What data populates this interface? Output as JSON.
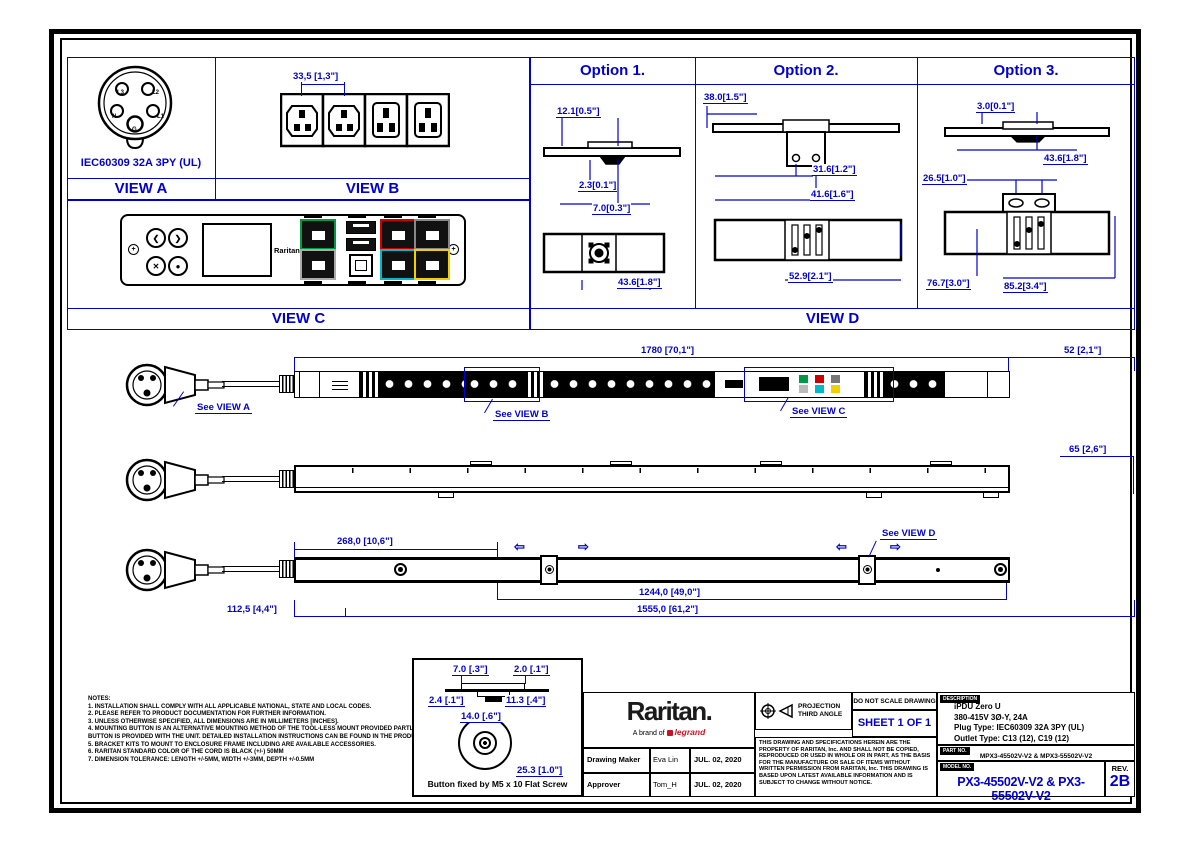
{
  "views": {
    "a": {
      "label": "VIEW A",
      "caption": "IEC60309 32A 3PY (UL)",
      "pins": [
        "L3",
        "L2",
        "N",
        "L1",
        "G"
      ]
    },
    "b": {
      "label": "VIEW B",
      "dim": "33,5 [1,3\"]"
    },
    "c": {
      "label": "VIEW C",
      "brand": "Raritan"
    },
    "d": {
      "label": "VIEW D"
    }
  },
  "options": [
    {
      "title": "Option 1.",
      "d1": "12.1[0.5\"]",
      "d2": "2.3[0.1\"]",
      "d3": "7.0[0.3\"]",
      "d4": "43.6[1.8\"]"
    },
    {
      "title": "Option 2.",
      "d1": "38.0[1.5\"]",
      "d2": "31.6[1.2\"]",
      "d3": "41.6[1.6\"]",
      "d4": "52.9[2.1\"]"
    },
    {
      "title": "Option 3.",
      "d1": "3.0[0.1\"]",
      "d2": "43.6[1.8\"]",
      "d3": "26.5[1.0\"]",
      "d4": "76.7[3.0\"]",
      "d5": "85.2[3.4\"]"
    }
  ],
  "assembly": {
    "front": {
      "dim_total": "1780 [70,1\"]",
      "dim_end": "52 [2,1\"]",
      "see_a": "See VIEW A",
      "see_b": "See VIEW B",
      "see_c": "See VIEW C"
    },
    "side": {
      "dim_depth": "65 [2,6\"]"
    },
    "rear": {
      "dim_offset": "268,0 [10,6\"]",
      "dim_span": "1244,0 [49,0\"]",
      "dim_overall": "1555,0 [61,2\"]",
      "dim_start": "112,5 [4,4\"]",
      "see_d": "See VIEW D"
    }
  },
  "button_detail": {
    "d1": "7.0 [.3\"]",
    "d2": "2.0 [.1\"]",
    "d3": "2.4 [.1\"]",
    "d4": "11.3 [.4\"]",
    "d5": "14.0 [.6\"]",
    "d6": "25.3 [1.0\"]",
    "caption": "Button fixed by M5 x 10 Flat Screw"
  },
  "notes": {
    "title": "NOTES:",
    "lines": [
      "1. INSTALLATION SHALL COMPLY WITH ALL APPLICABLE NATIONAL, STATE AND LOCAL CODES.",
      "2. PLEASE REFER TO PRODUCT DOCUMENTATION FOR FURTHER INFORMATION.",
      "3. UNLESS OTHERWISE SPECIFIED, ALL DIMENSIONS ARE IN MILLIMETERS [INCHES].",
      "4. MOUNTING BUTTON IS AN ALTERNATIVE MOUNTING METHOD OF THE TOOL-LESS MOUNT PROVIDED PARTLY ENCLOSURE.",
      "    BUTTON IS PROVIDED WITH THE UNIT. DETAILED INSTALLATION INSTRUCTIONS CAN BE FOUND IN THE PRODUCT MANUAL.",
      "5. BRACKET KITS TO MOUNT TO ENCLOSURE FRAME INCLUDING ARE AVAILABLE ACCESSORIES.",
      "6. RARITAN STANDARD COLOR OF THE CORD IS BLACK (+/-) 50MM",
      "7. DIMENSION TOLERANCE: LENGTH +/-5MM, WIDTH +/-3MM, DEPTH +/-0.5MM"
    ]
  },
  "title_block": {
    "brand": "Raritan.",
    "brand_sub_prefix": "A brand of",
    "brand_sub_highlight": "legrand",
    "rows": [
      {
        "label": "Drawing Maker",
        "name": "Eva Lin",
        "date": "JUL. 02, 2020"
      },
      {
        "label": "Approver",
        "name": "Tom_H",
        "date": "JUL. 02, 2020"
      }
    ],
    "projection_line1": "PROJECTION",
    "projection_line2": "THIRD ANGLE",
    "no_scale": "DO NOT SCALE DRAWING",
    "sheet": "SHEET 1 OF 1",
    "legal": "THIS DRAWING AND SPECIFICATIONS HEREIN ARE THE PROPERTY OF RARITAN, Inc. AND SHALL NOT BE COPIED, REPRODUCED OR USED IN WHOLE OR IN PART, AS THE BASIS FOR THE MANUFACTURE OR SALE OF ITEMS WITHOUT WRITTEN PERMISSION FROM RARITAN, Inc. THIS DRAWING IS BASED UPON LATEST AVAILABLE INFORMATION AND IS SUBJECT TO CHANGE WITHOUT NOTICE.",
    "description_label": "DESCRIPTION",
    "description": [
      "iPDU Zero U",
      "380-415V 3Ø-Y, 24A",
      "Plug Type: IEC60309 32A 3PY (UL)",
      "Outlet Type: C13 (12), C19 (12)"
    ],
    "part_label": "PART NO.",
    "part_no": "MPX3-45502V-V2 & MPX3-55502V-V2",
    "model_label": "MODEL NO.",
    "model_no": "PX3-45502V-V2 & PX3-55502V-V2",
    "rev_label": "REV.",
    "rev": "2B"
  },
  "colors": {
    "dimension_blue": "#0000d4",
    "legrand_red": "#cc1122",
    "port_green": "#009a44",
    "port_red": "#d00000",
    "port_cyan": "#00b8c8",
    "port_yellow": "#f0d000"
  }
}
